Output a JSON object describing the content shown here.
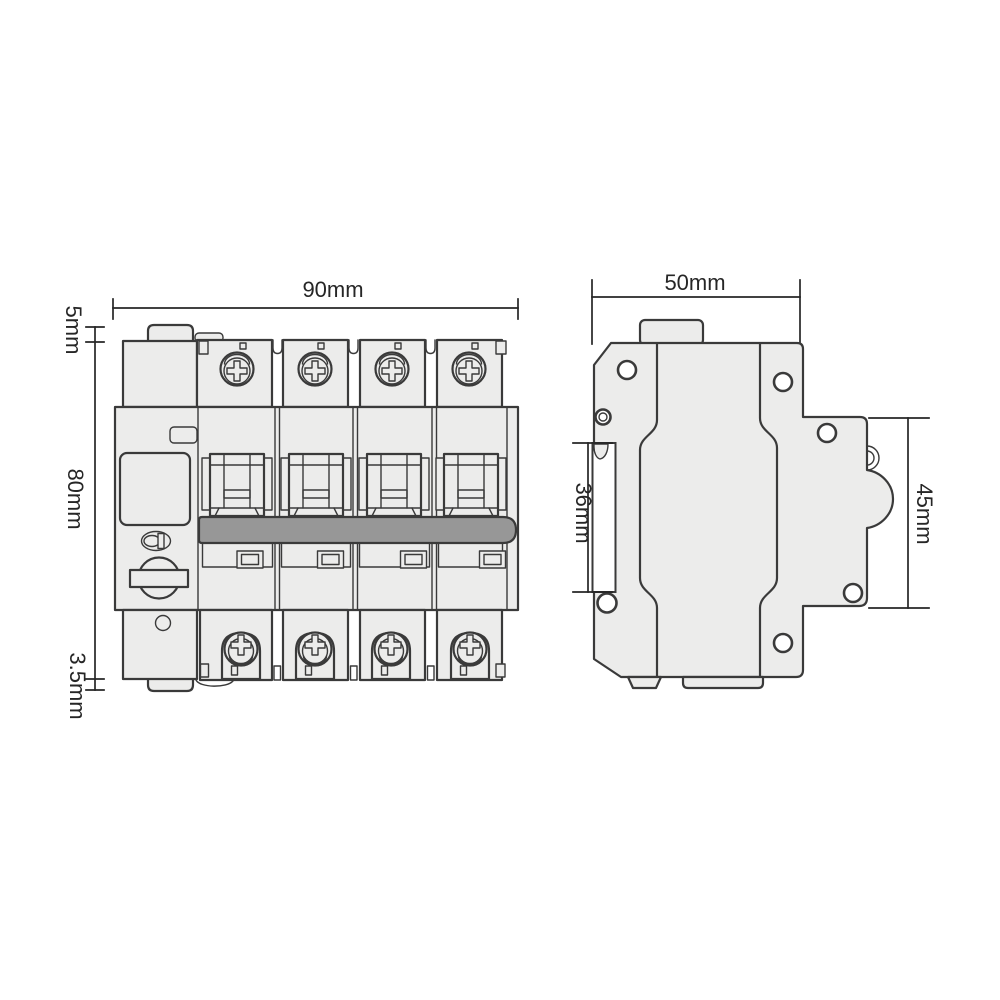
{
  "drawing": {
    "views": {
      "front": {
        "pole_count": 4,
        "dimensions": {
          "width": "90mm",
          "top_tab": "5mm",
          "body_height": "80mm",
          "bottom_tab": "3.5mm"
        }
      },
      "side": {
        "dimensions": {
          "width": "50mm",
          "din_slot": "36mm",
          "front_section": "45mm"
        }
      }
    }
  },
  "colors": {
    "background": "#ffffff",
    "outline": "#3a3a3a",
    "body_fill": "#ececeb",
    "white_fill": "#ffffff",
    "tie_bar_gray": "#979797",
    "dimension_color": "#262626"
  }
}
